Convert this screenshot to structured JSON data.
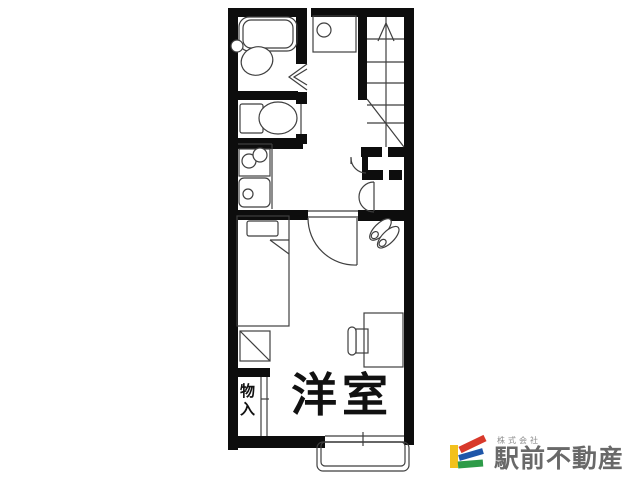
{
  "plan": {
    "room_label": "洋室",
    "closet_label": "物入",
    "wall_color": "#0d0d0d",
    "line_color": "#3f3f3f",
    "fixtures": [
      "bathtub",
      "washbasin",
      "toilet",
      "gas-stove",
      "kitchen-sink",
      "washing-machine-pan",
      "staircase-up",
      "entrance-shoes",
      "bed",
      "pillow",
      "side-table",
      "desk",
      "chair",
      "storage-closet",
      "sliding-window",
      "balcony",
      "door-swing-arcs",
      "folding-bath-door"
    ]
  },
  "logo": {
    "company_prefix": "株式会社",
    "company_name": "駅前不動産",
    "colors": {
      "yellow": "#f2c11d",
      "red": "#d8392b",
      "blue": "#1e56a9",
      "green": "#2d9b48",
      "text_dark": "#696969",
      "text_light": "#8c8c8c"
    }
  }
}
